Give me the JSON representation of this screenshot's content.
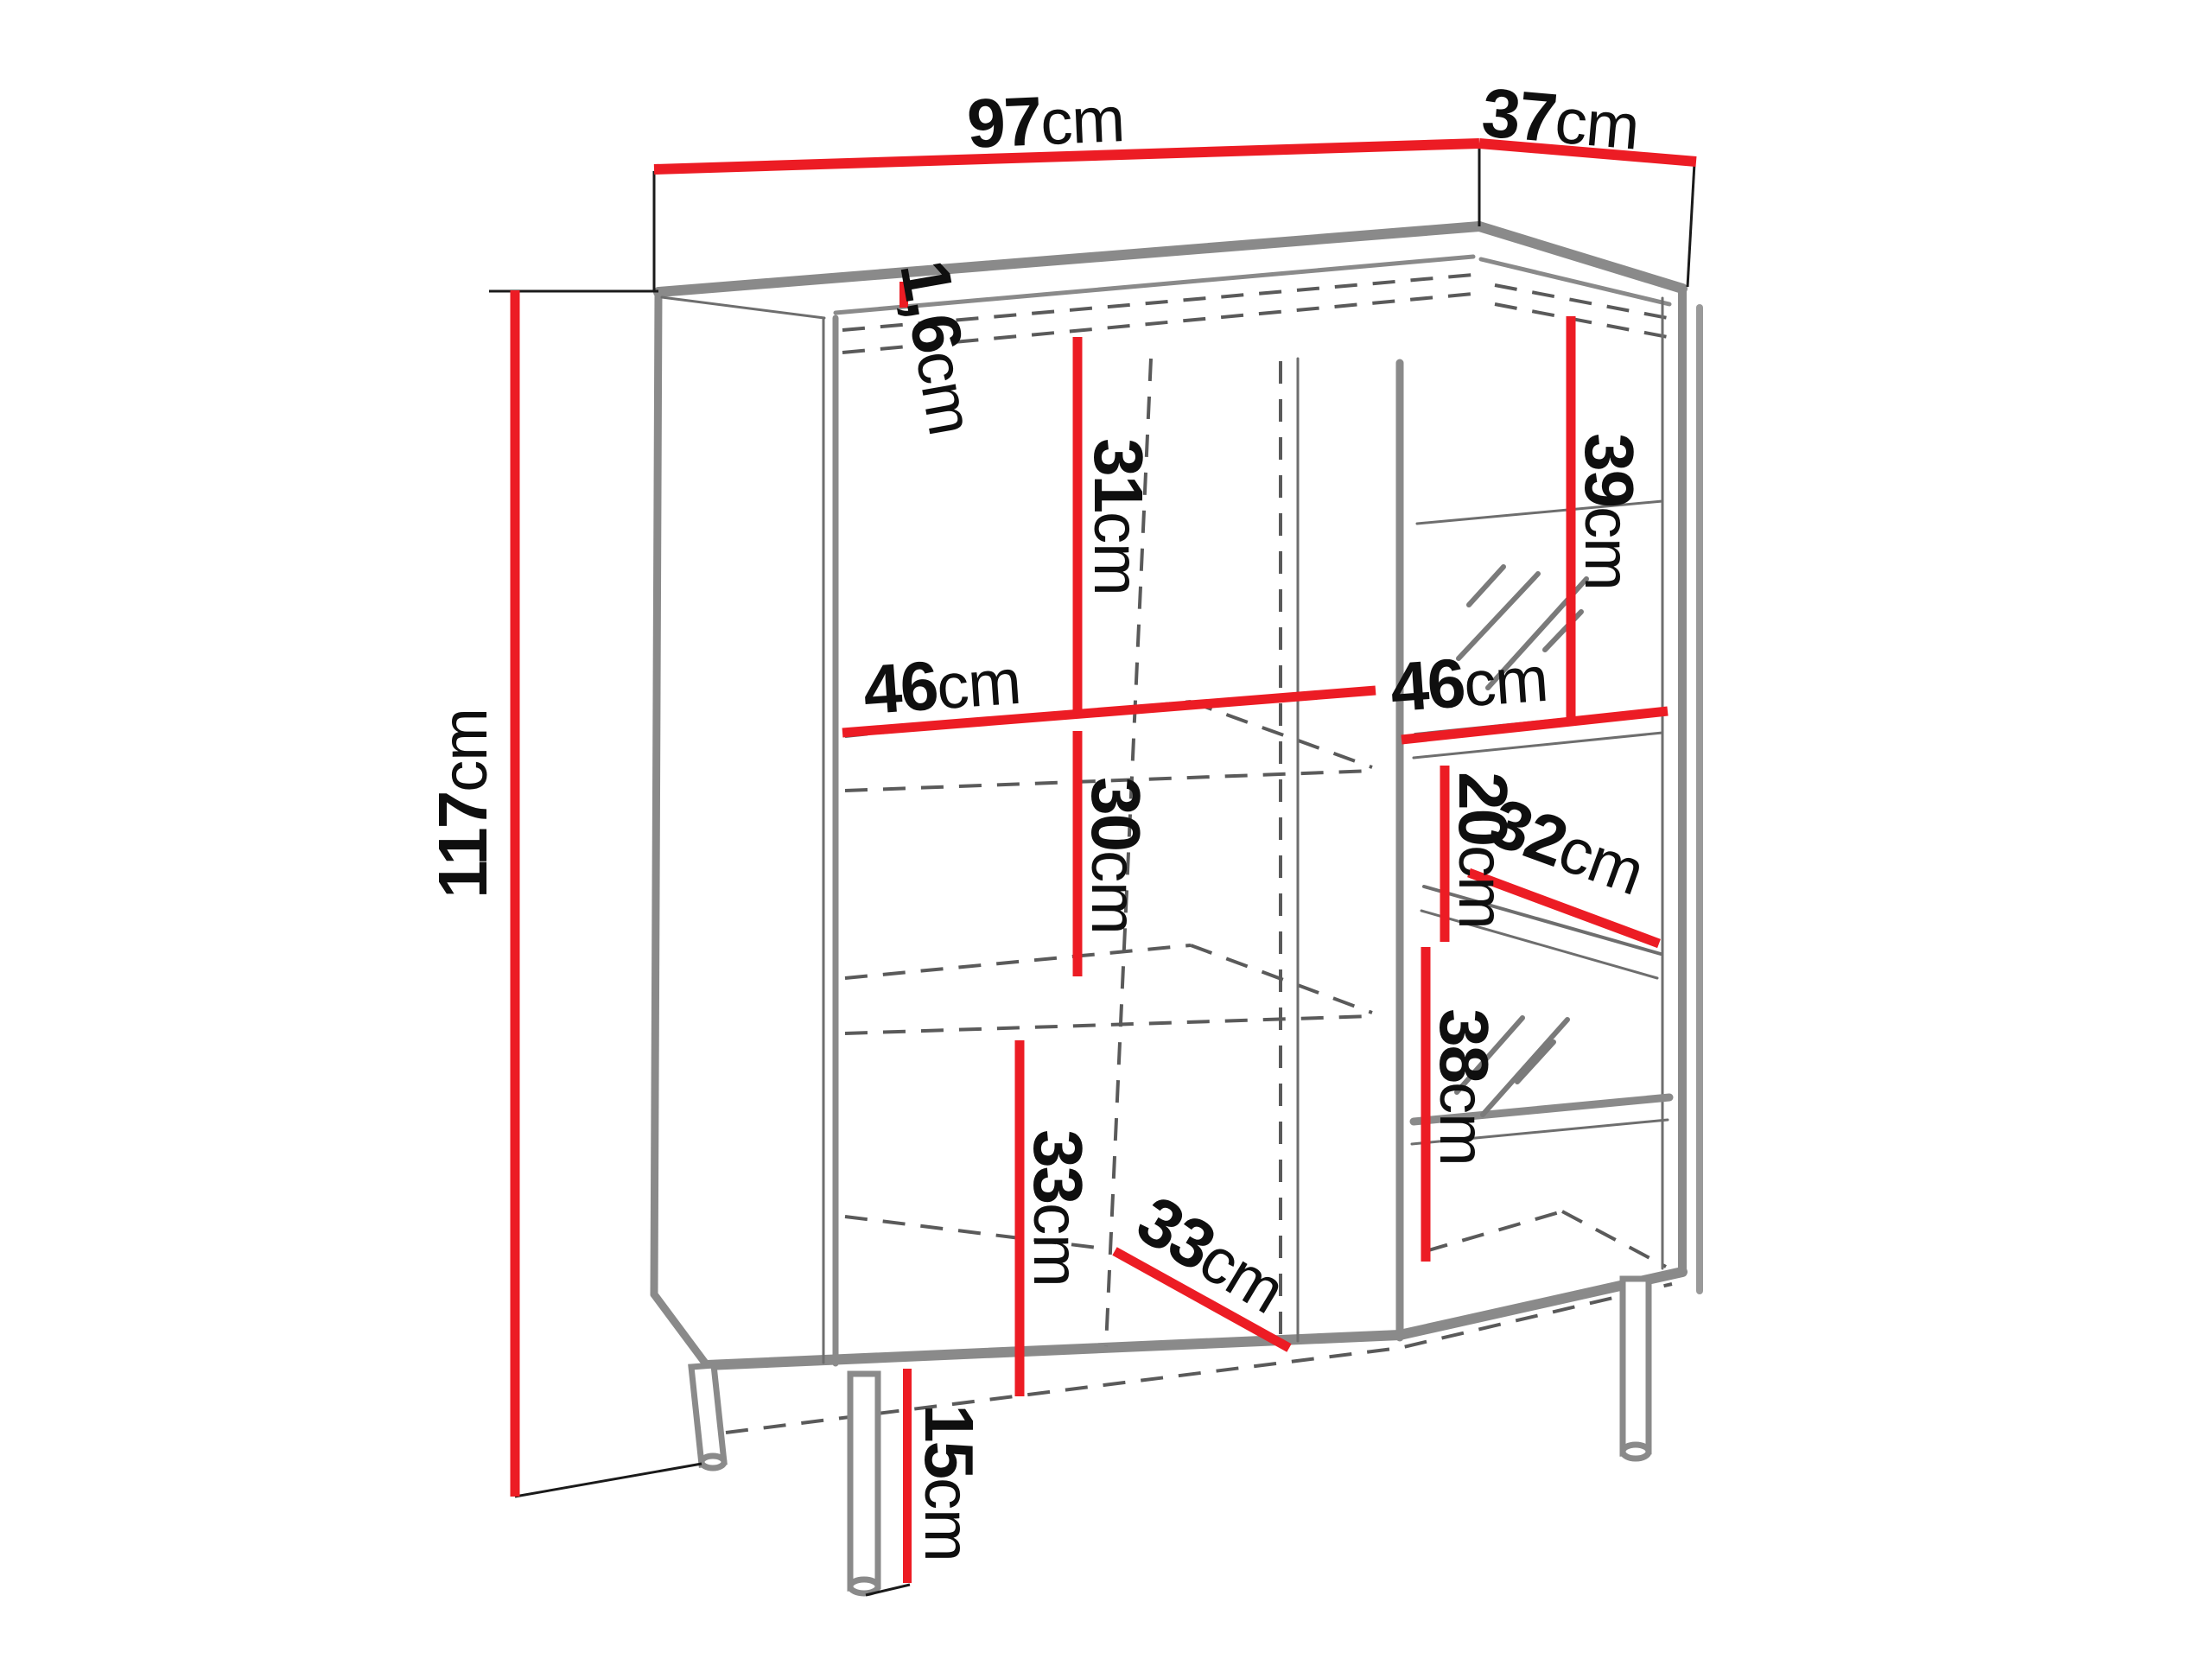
{
  "diagram": {
    "kind": "furniture dimension line drawing",
    "subject": "display cabinet / highboard with left door and right glass section, on metal legs",
    "units": "cm"
  },
  "colors": {
    "dimension_red": "#ec1c24",
    "body_gray": "#8a8a8a",
    "shadow_gray": "#9a9a9a",
    "hidden_line_gray": "#5a5a5a",
    "text_black": "#0f0f0f",
    "background": "#ffffff"
  },
  "dims": {
    "width": {
      "num": "97",
      "unit": "cm"
    },
    "depth": {
      "num": "37",
      "unit": "cm"
    },
    "height": {
      "num": "117",
      "unit": "cm"
    },
    "top_thickness": {
      "num": "1,6",
      "unit": "cm"
    },
    "left_top_section": {
      "num": "31",
      "unit": "cm"
    },
    "left_shelf_width": {
      "num": "46",
      "unit": "cm"
    },
    "left_mid_section": {
      "num": "30",
      "unit": "cm"
    },
    "left_bottom_section": {
      "num": "33",
      "unit": "cm"
    },
    "left_depth": {
      "num": "33",
      "unit": "cm"
    },
    "right_top_section": {
      "num": "39",
      "unit": "cm"
    },
    "right_shelf_width": {
      "num": "46",
      "unit": "cm"
    },
    "right_gap": {
      "num": "20",
      "unit": "cm"
    },
    "right_shelf_depth": {
      "num": "32",
      "unit": "cm"
    },
    "right_bottom_section": {
      "num": "38",
      "unit": "cm"
    },
    "leg_height": {
      "num": "15",
      "unit": "cm"
    }
  }
}
